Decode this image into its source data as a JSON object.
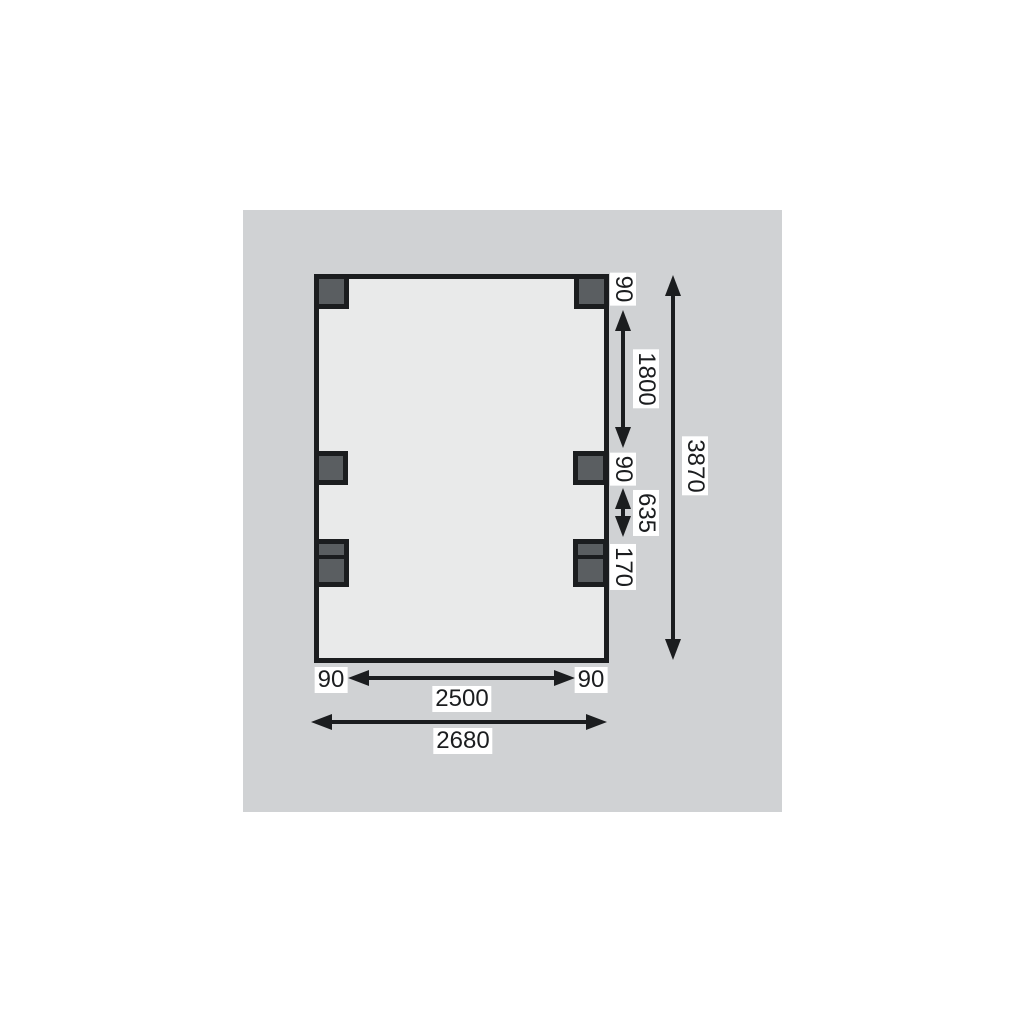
{
  "diagram": {
    "kind": "carport-floor-plan-dimension-drawing",
    "labels": {
      "right": {
        "post_top": "90",
        "span_top": "1800",
        "post_mid": "90",
        "span_mid": "635",
        "beam_block": "170",
        "total_depth": "3870"
      },
      "bottom": {
        "post_left": "90",
        "inner_width": "2500",
        "post_right": "90",
        "total_width": "2680"
      }
    },
    "colors": {
      "canvas_bg": "#d0d2d4",
      "plan_fill": "#e9eaea",
      "post_fill": "#5a5e61",
      "ink": "#1b1d1f",
      "label_bg": "#ffffff"
    }
  }
}
